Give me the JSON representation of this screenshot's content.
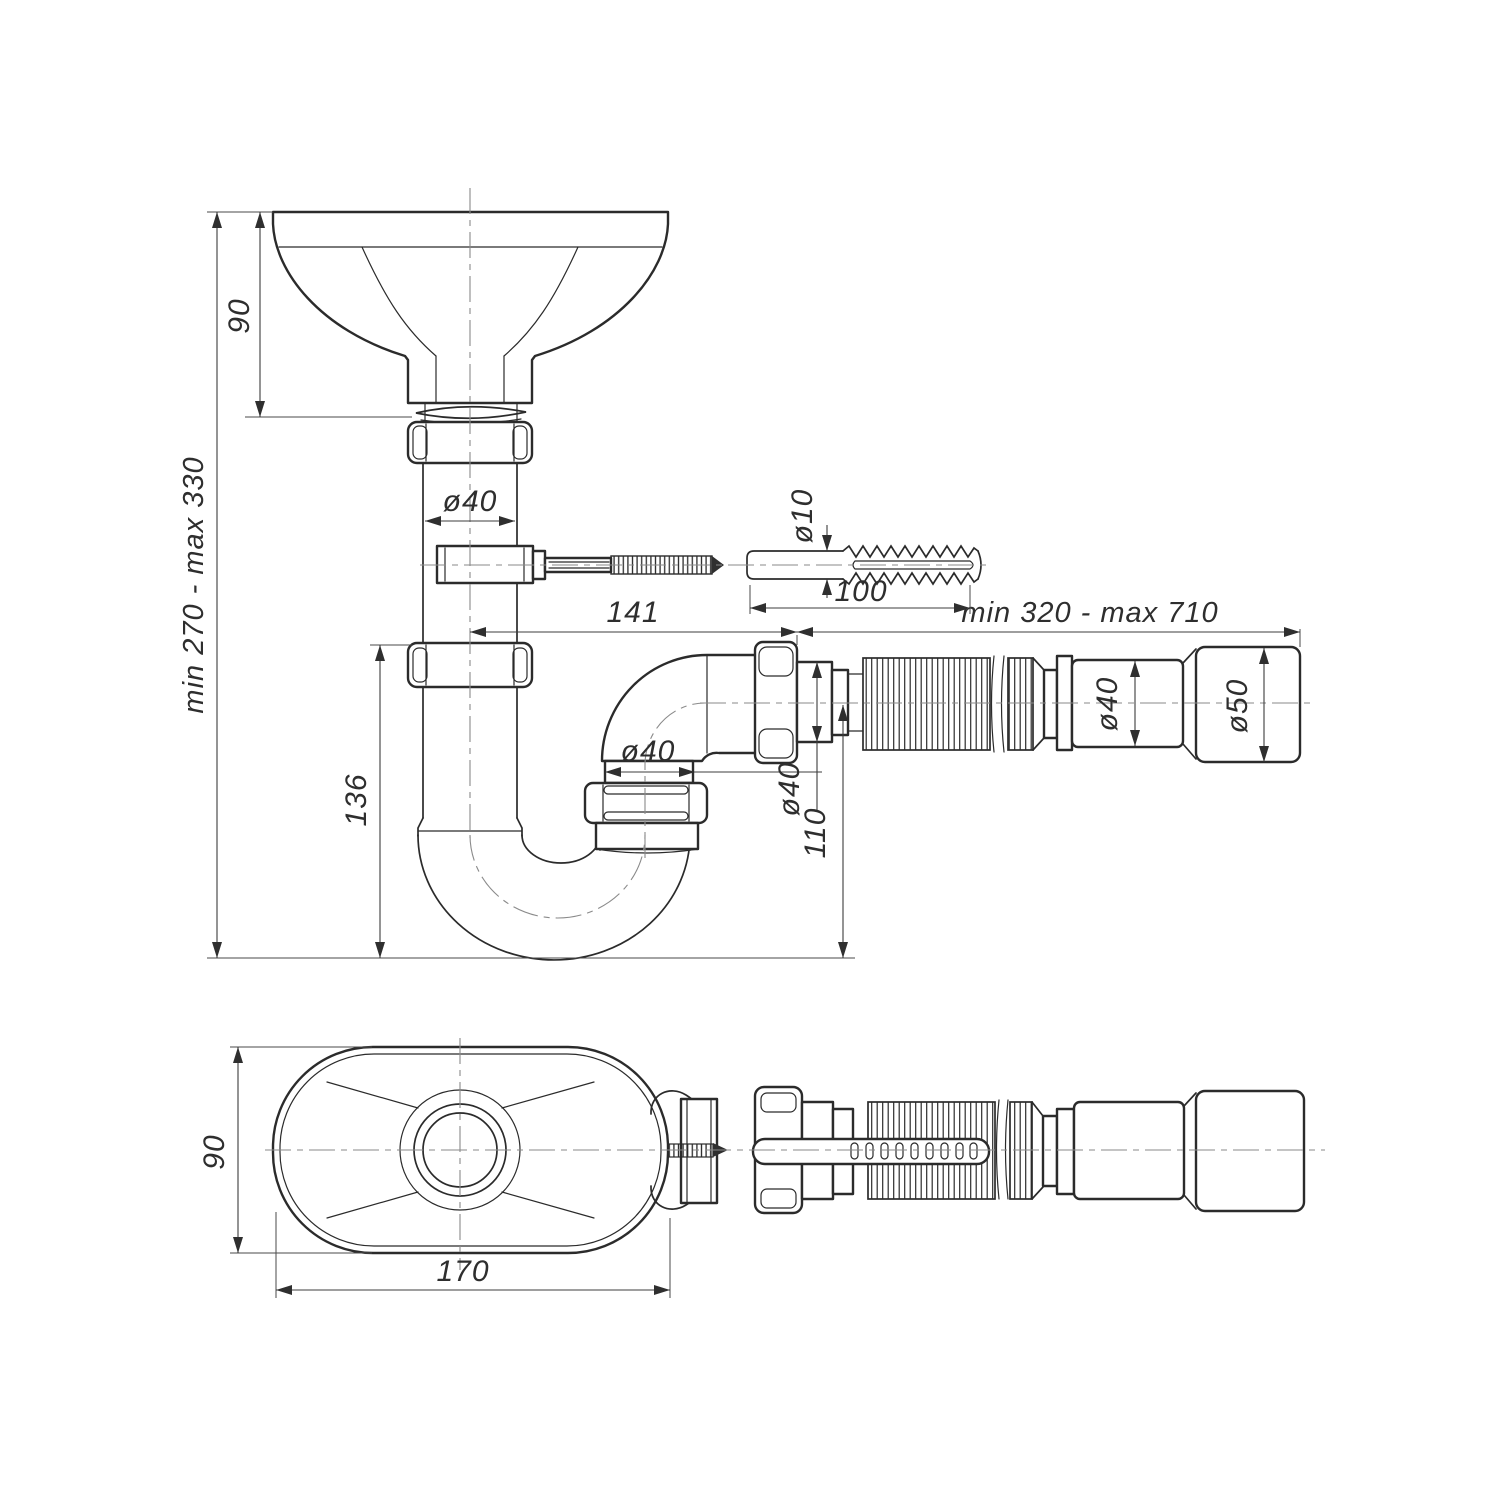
{
  "drawing": {
    "background": "#ffffff",
    "line_color": "#2b2b2b",
    "dimension_color": "#3c3c3c"
  },
  "dimensions": {
    "side_view": {
      "funnel_height": "90",
      "overall_height": "min 270 - max 330",
      "inlet_pipe_diameter": "ø40",
      "wall_plug_diameter": "ø10",
      "trap_width": "141",
      "wall_plug_length": "100",
      "flexible_pipe_length": "min 320 - max 710",
      "trap_pipe_diameter": "ø40",
      "outlet_diameter": "ø40",
      "outlet_axis_height": "110",
      "trap_depth": "136",
      "connector_diameter": "ø40",
      "end_cup_diameter": "ø50"
    },
    "top_view": {
      "funnel_width": "90",
      "funnel_length": "170"
    }
  }
}
